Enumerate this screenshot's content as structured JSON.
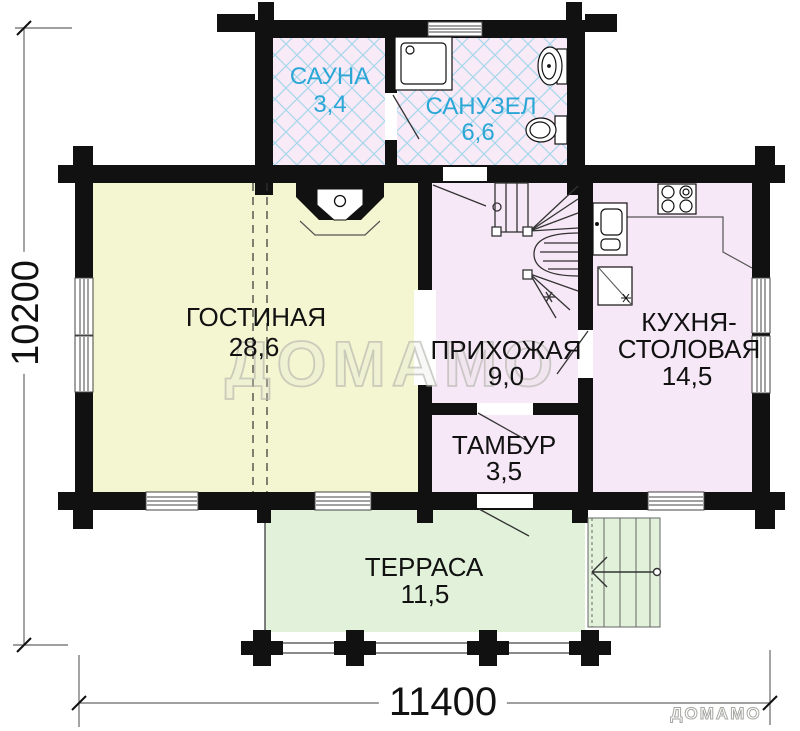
{
  "rooms": {
    "sauna": {
      "name": "САУНА",
      "area": "3,4"
    },
    "bathroom": {
      "name": "САНУЗЕЛ",
      "area": "6,6"
    },
    "living": {
      "name": "ГОСТИНАЯ",
      "area": "28,6"
    },
    "hallway": {
      "name": "ПРИХОЖАЯ",
      "area": "9,0"
    },
    "kitchen": {
      "name_line1": "КУХНЯ-",
      "name_line2": "СТОЛОВАЯ",
      "area": "14,5"
    },
    "vestibule": {
      "name": "ТАМБУР",
      "area": "3,5"
    },
    "terrace": {
      "name": "ТЕРРАСА",
      "area": "11,5"
    }
  },
  "dimensions": {
    "overall_width_mm": "11400",
    "overall_depth_mm": "10200"
  },
  "watermark": {
    "large": "ДОМАМО",
    "small": "ДОМАМО"
  },
  "colors": {
    "wall": "#111111",
    "living_fill": "#F4F6D2",
    "room_fill_pink": "#F6E8F6",
    "wet_room_fill": "#F9EAF8",
    "terrace_fill": "#E1F1DA",
    "hatch": "#A6D7EA",
    "label_accent": "#2BA7D6",
    "label_text": "#111111",
    "watermark_outline": "#B2B2AA"
  }
}
